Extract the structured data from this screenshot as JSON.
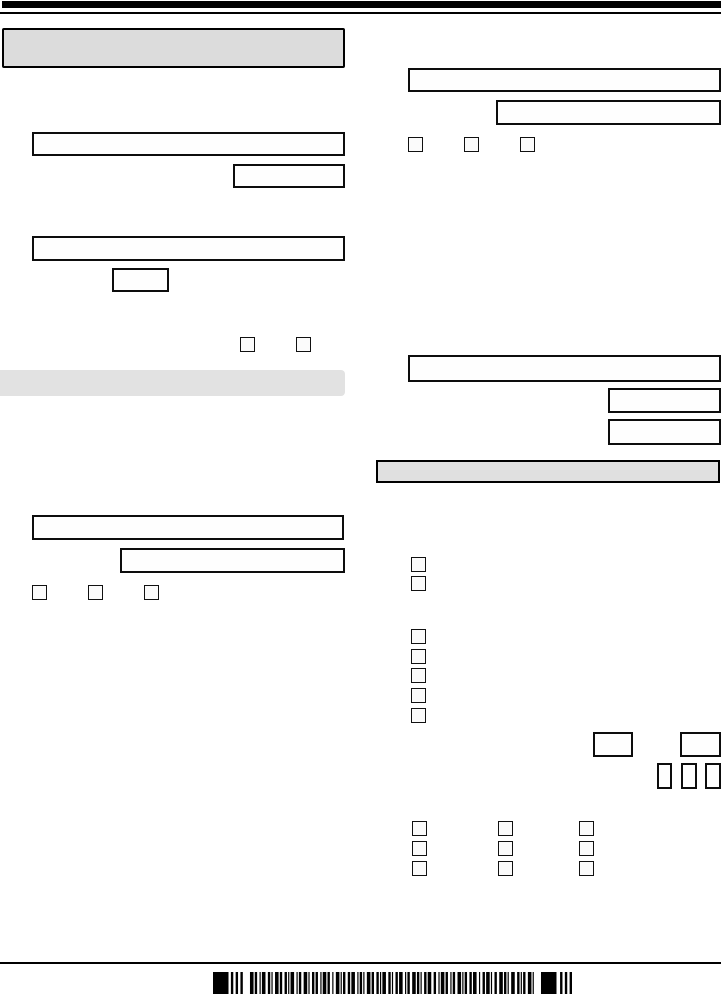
{
  "page": {
    "background": "#ffffff",
    "ink": "#000000",
    "header_fill": "#dcdcdc",
    "left_section_fill": "#e2e2e2",
    "right_section_fill": "#e0e0e0"
  },
  "rules": [
    {
      "name": "top-black-bar",
      "x": 2,
      "y": 1,
      "w": 719,
      "h": 7,
      "fill": "#000000"
    },
    {
      "name": "top-rule",
      "x": 0,
      "y": 12,
      "w": 721,
      "h": 2,
      "fill": "#000000"
    },
    {
      "name": "bottom-rule",
      "x": 0,
      "y": 962,
      "w": 721,
      "h": 2,
      "fill": "#000000"
    }
  ],
  "section_bars": [
    {
      "name": "form-header-box",
      "x": 2,
      "y": 28,
      "w": 343,
      "h": 40,
      "fill": "#dcdcdc",
      "bordered": true,
      "radius": "2px"
    },
    {
      "name": "left-section-header",
      "x": 0,
      "y": 370,
      "w": 345,
      "h": 26,
      "fill": "#e2e2e2",
      "bordered": false,
      "radius": "0 4px 4px 0"
    },
    {
      "name": "right-section-header",
      "x": 376,
      "y": 460,
      "w": 344,
      "h": 23,
      "fill": "#e0e0e0",
      "bordered": true,
      "radius": "0"
    }
  ],
  "input_boxes": [
    {
      "name": "input-box-left-1",
      "x": 32,
      "y": 132,
      "w": 313,
      "h": 24
    },
    {
      "name": "input-box-left-2",
      "x": 233,
      "y": 164,
      "w": 112,
      "h": 24
    },
    {
      "name": "input-box-left-3",
      "x": 32,
      "y": 236,
      "w": 313,
      "h": 25
    },
    {
      "name": "input-box-left-4-small",
      "x": 112,
      "y": 268,
      "w": 57,
      "h": 24
    },
    {
      "name": "input-box-left-5",
      "x": 32,
      "y": 515,
      "w": 312,
      "h": 25
    },
    {
      "name": "input-box-left-6",
      "x": 120,
      "y": 548,
      "w": 225,
      "h": 25
    },
    {
      "name": "input-box-right-1",
      "x": 408,
      "y": 68,
      "w": 313,
      "h": 24
    },
    {
      "name": "input-box-right-2",
      "x": 496,
      "y": 100,
      "w": 225,
      "h": 25
    },
    {
      "name": "input-box-right-3",
      "x": 408,
      "y": 355,
      "w": 313,
      "h": 27
    },
    {
      "name": "input-box-right-4",
      "x": 608,
      "y": 388,
      "w": 113,
      "h": 25
    },
    {
      "name": "input-box-right-5",
      "x": 608,
      "y": 419,
      "w": 113,
      "h": 26
    },
    {
      "name": "input-box-right-6-small",
      "x": 593,
      "y": 732,
      "w": 40,
      "h": 25
    },
    {
      "name": "input-box-right-7-small",
      "x": 680,
      "y": 732,
      "w": 41,
      "h": 25
    },
    {
      "name": "digit-box-1",
      "x": 657,
      "y": 763,
      "w": 15,
      "h": 26
    },
    {
      "name": "digit-box-2",
      "x": 681,
      "y": 763,
      "w": 16,
      "h": 26
    },
    {
      "name": "digit-box-3",
      "x": 705,
      "y": 763,
      "w": 16,
      "h": 26
    }
  ],
  "checkboxes": [
    {
      "name": "checkbox-left-pair-1",
      "x": 240,
      "y": 337,
      "w": 15,
      "h": 15
    },
    {
      "name": "checkbox-left-pair-2",
      "x": 296,
      "y": 337,
      "w": 15,
      "h": 15
    },
    {
      "name": "checkbox-left-row-1",
      "x": 32,
      "y": 585,
      "w": 15,
      "h": 15
    },
    {
      "name": "checkbox-left-row-2",
      "x": 88,
      "y": 585,
      "w": 15,
      "h": 15
    },
    {
      "name": "checkbox-left-row-3",
      "x": 144,
      "y": 585,
      "w": 15,
      "h": 15
    },
    {
      "name": "checkbox-right-row-1",
      "x": 408,
      "y": 137,
      "w": 15,
      "h": 15
    },
    {
      "name": "checkbox-right-row-2",
      "x": 464,
      "y": 137,
      "w": 15,
      "h": 15
    },
    {
      "name": "checkbox-right-row-3",
      "x": 520,
      "y": 137,
      "w": 15,
      "h": 15
    },
    {
      "name": "checkbox-stack2-1",
      "x": 411,
      "y": 557,
      "w": 15,
      "h": 15
    },
    {
      "name": "checkbox-stack2-2",
      "x": 411,
      "y": 576,
      "w": 15,
      "h": 15
    },
    {
      "name": "checkbox-stack5-1",
      "x": 411,
      "y": 629,
      "w": 15,
      "h": 15
    },
    {
      "name": "checkbox-stack5-2",
      "x": 411,
      "y": 649,
      "w": 15,
      "h": 15
    },
    {
      "name": "checkbox-stack5-3",
      "x": 411,
      "y": 668,
      "w": 15,
      "h": 15
    },
    {
      "name": "checkbox-stack5-4",
      "x": 411,
      "y": 688,
      "w": 15,
      "h": 15
    },
    {
      "name": "checkbox-stack5-5",
      "x": 411,
      "y": 708,
      "w": 15,
      "h": 15
    },
    {
      "name": "checkbox-grid-r1c1",
      "x": 412,
      "y": 821,
      "w": 15,
      "h": 15
    },
    {
      "name": "checkbox-grid-r1c2",
      "x": 498,
      "y": 821,
      "w": 15,
      "h": 15
    },
    {
      "name": "checkbox-grid-r1c3",
      "x": 579,
      "y": 821,
      "w": 15,
      "h": 15
    },
    {
      "name": "checkbox-grid-r2c1",
      "x": 412,
      "y": 841,
      "w": 15,
      "h": 15
    },
    {
      "name": "checkbox-grid-r2c2",
      "x": 498,
      "y": 841,
      "w": 15,
      "h": 15
    },
    {
      "name": "checkbox-grid-r2c3",
      "x": 579,
      "y": 841,
      "w": 15,
      "h": 15
    },
    {
      "name": "checkbox-grid-r3c1",
      "x": 412,
      "y": 861,
      "w": 15,
      "h": 15
    },
    {
      "name": "checkbox-grid-r3c2",
      "x": 498,
      "y": 861,
      "w": 15,
      "h": 15
    },
    {
      "name": "checkbox-grid-r3c3",
      "x": 579,
      "y": 861,
      "w": 15,
      "h": 15
    }
  ],
  "barcode": {
    "name": "barcode-icon",
    "x": 213,
    "y": 972,
    "w": 359,
    "h": 22,
    "bars": [
      13,
      -2,
      2,
      -2,
      2,
      -2,
      2,
      -6,
      3,
      -1,
      2,
      -2,
      1,
      -1,
      3,
      -2,
      2,
      -1,
      1,
      -2,
      3,
      -1,
      2,
      -2,
      2,
      -1,
      1,
      -1,
      3,
      -2,
      1,
      -1,
      2,
      -2,
      3,
      -1,
      1,
      -2,
      2,
      -1,
      2,
      -2,
      1,
      -1,
      3,
      -1,
      2,
      -2,
      1,
      -2,
      3,
      -1,
      1,
      -1,
      2,
      -2,
      2,
      -1,
      3,
      -2,
      1,
      -1,
      2,
      -1,
      1,
      -2,
      3,
      -1,
      2,
      -2,
      2,
      -1,
      1,
      -1,
      3,
      -2,
      2,
      -1,
      1,
      -2,
      2,
      -1,
      3,
      -2,
      1,
      -1,
      2,
      -2,
      3,
      -1,
      2,
      -1,
      1,
      -2,
      2,
      -1,
      3,
      -2,
      2,
      -2,
      1,
      -1,
      3,
      -1,
      2,
      -2,
      1,
      -1,
      2,
      -2,
      3,
      -1,
      1,
      -1,
      2,
      -2,
      2,
      -1,
      3,
      -2,
      1,
      -2,
      2,
      -1,
      3,
      -1,
      1,
      -2,
      2,
      -2,
      3,
      -1,
      2,
      -1,
      1,
      -2,
      3,
      -2,
      2,
      -1,
      1,
      -1,
      2,
      -2,
      3,
      -1,
      1,
      -6,
      13,
      -3,
      2,
      -2,
      2,
      -2,
      2
    ]
  }
}
